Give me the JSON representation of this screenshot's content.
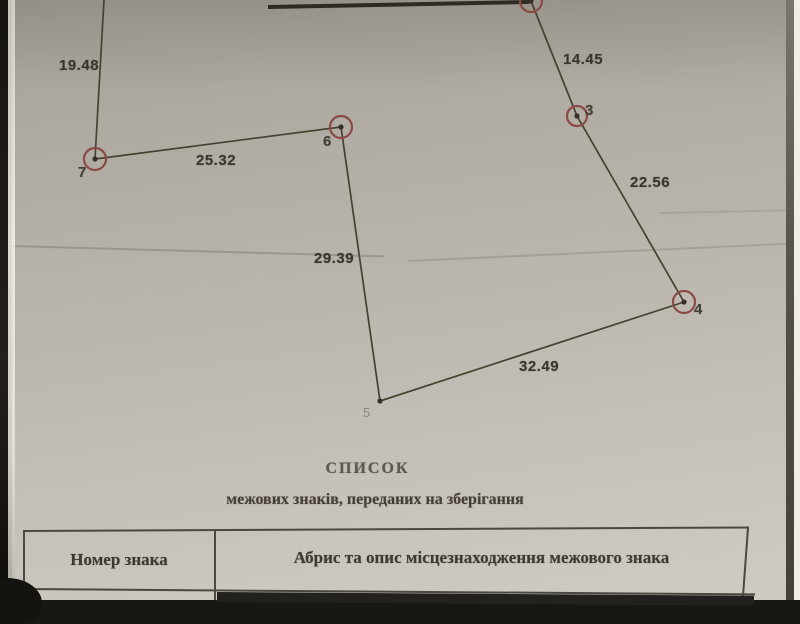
{
  "document": {
    "title": "СПИСОК",
    "subtitle": "межових знаків, переданих на зберігання"
  },
  "table": {
    "col1_header": "Номер знака",
    "col2_header": "Абрис та опис місцезнаходження межового знака"
  },
  "diagram": {
    "type": "boundary-sketch",
    "line_color": "#47412f",
    "thick_line_color": "#2e2a24",
    "circle_color": "#8a4a43",
    "dot_color": "#362f28",
    "points": [
      {
        "id": "2",
        "x": 531,
        "y": 1,
        "r": 11,
        "circled": true,
        "label": "",
        "lx": 0,
        "ly": 0
      },
      {
        "id": "3",
        "x": 577,
        "y": 116,
        "r": 10,
        "circled": true,
        "label": "3",
        "lx": 585,
        "ly": 102
      },
      {
        "id": "4",
        "x": 684,
        "y": 302,
        "r": 11,
        "circled": true,
        "label": "4",
        "lx": 694,
        "ly": 301
      },
      {
        "id": "5",
        "x": 380,
        "y": 401,
        "r": 3,
        "circled": false,
        "label": "5",
        "lx": 363,
        "ly": 405,
        "faint": true
      },
      {
        "id": "6",
        "x": 341,
        "y": 127,
        "r": 11,
        "circled": true,
        "label": "6",
        "lx": 323,
        "ly": 133
      },
      {
        "id": "7",
        "x": 95,
        "y": 159,
        "r": 11,
        "circled": true,
        "label": "7",
        "lx": 78,
        "ly": 164
      }
    ],
    "edges": [
      {
        "x1": 268,
        "y1": 7,
        "x2": 529,
        "y2": 2,
        "w": 4,
        "thick": true,
        "label": ""
      },
      {
        "x1": 104,
        "y1": 0,
        "x2": 95,
        "y2": 159,
        "w": 1.7,
        "label": "19.48",
        "lx": 59,
        "ly": 57
      },
      {
        "x1": 95,
        "y1": 159,
        "x2": 341,
        "y2": 127,
        "w": 1.7,
        "label": "25.32",
        "lx": 196,
        "ly": 152
      },
      {
        "x1": 341,
        "y1": 127,
        "x2": 380,
        "y2": 401,
        "w": 1.7,
        "label": "29.39",
        "lx": 314,
        "ly": 250
      },
      {
        "x1": 380,
        "y1": 401,
        "x2": 684,
        "y2": 302,
        "w": 1.7,
        "label": "32.49",
        "lx": 519,
        "ly": 358
      },
      {
        "x1": 684,
        "y1": 302,
        "x2": 577,
        "y2": 116,
        "w": 1.7,
        "label": "22.56",
        "lx": 630,
        "ly": 174
      },
      {
        "x1": 577,
        "y1": 116,
        "x2": 531,
        "y2": 1,
        "w": 1.7,
        "label": "14.45",
        "lx": 563,
        "ly": 51
      }
    ]
  }
}
